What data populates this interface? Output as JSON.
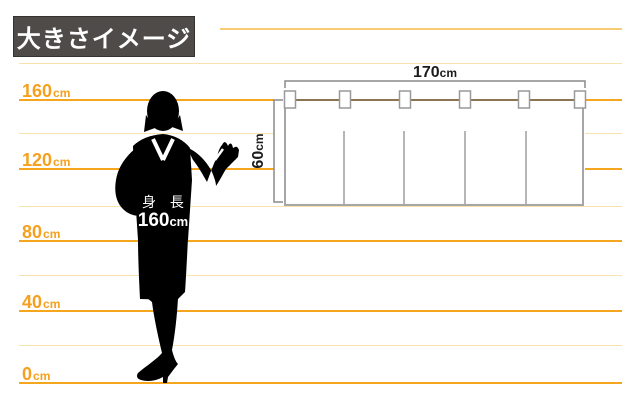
{
  "header": {
    "title": "大きさイメージ"
  },
  "ruler": {
    "labels": [
      {
        "value": "160",
        "unit": "cm"
      },
      {
        "value": "120",
        "unit": "cm"
      },
      {
        "value": "80",
        "unit": "cm"
      },
      {
        "value": "40",
        "unit": "cm"
      },
      {
        "value": "0",
        "unit": "cm"
      }
    ]
  },
  "person": {
    "caption_title": "身 長",
    "caption_value": "160",
    "caption_unit": "cm"
  },
  "noren": {
    "width_value": "170",
    "width_unit": "cm",
    "height_value": "60",
    "height_unit": "cm"
  },
  "colors": {
    "accent_orange": "#F5A61F",
    "pale_line": "#FAE2AC",
    "mid_line": "#F8CC74",
    "title_bg": "#4E4B48",
    "title_text": "#FFFFFF",
    "rod_brown": "#8C7352",
    "outline_gray": "#9E9E9E",
    "silhouette": "#000000"
  }
}
